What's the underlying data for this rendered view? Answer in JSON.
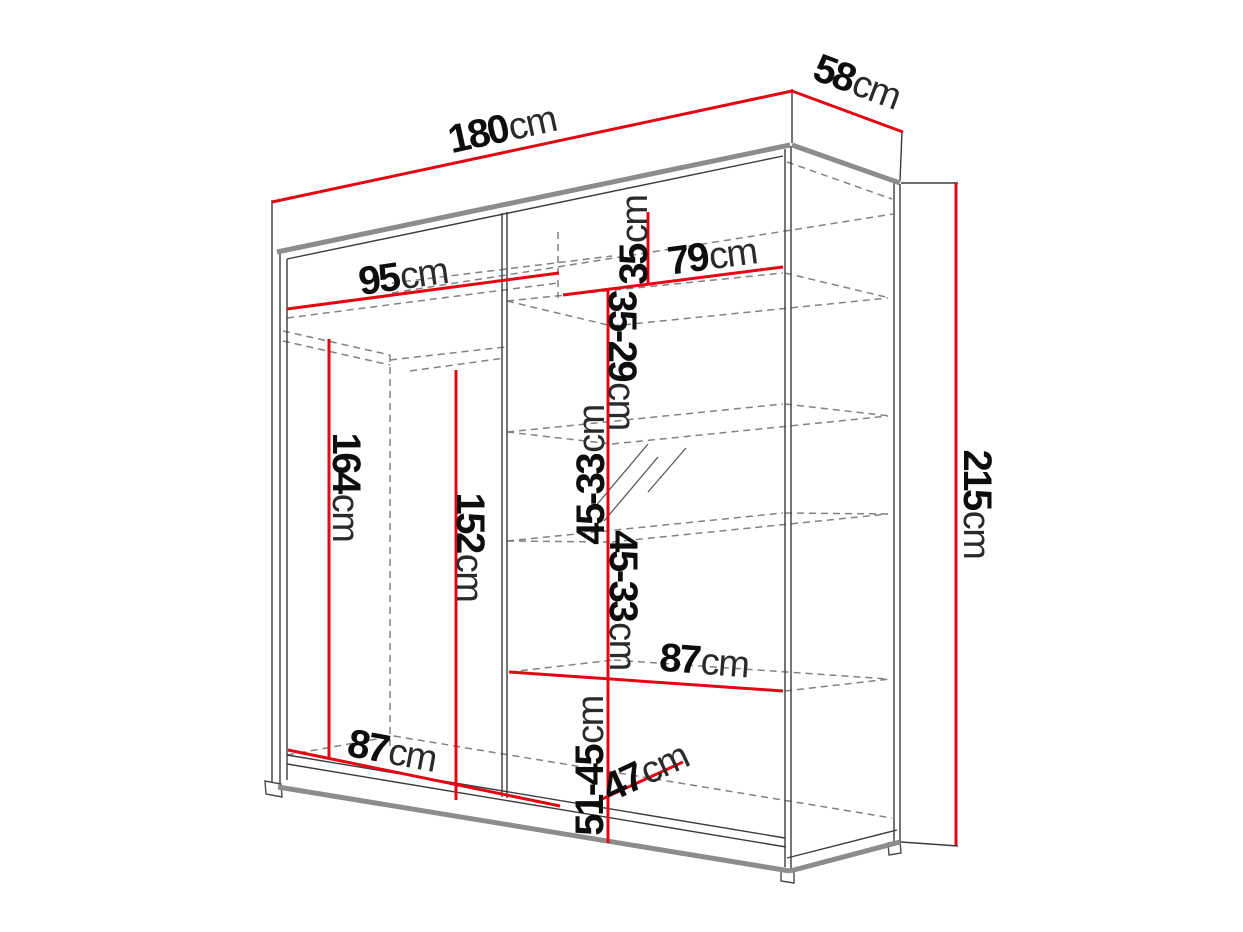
{
  "diagram": {
    "type": "wardrobe-dimension-drawing",
    "unit": "cm",
    "colors": {
      "dimension_red": "#e30613",
      "outline_thick": "#8c8c8c",
      "outline_thin": "#3c3c3c",
      "hidden_dashed": "#828282",
      "text": "#0d0d0d",
      "background": "#ffffff"
    },
    "dims": {
      "width": {
        "value": "180",
        "unit": "cm"
      },
      "depth": {
        "value": "58",
        "unit": "cm"
      },
      "height": {
        "value": "215",
        "unit": "cm"
      },
      "left_width": {
        "value": "95",
        "unit": "cm"
      },
      "top_shelf": {
        "value": "35",
        "unit": "cm"
      },
      "right_width": {
        "value": "79",
        "unit": "cm"
      },
      "gap_top": {
        "value": "35-29",
        "unit": "cm"
      },
      "gap_mid_upper": {
        "value": "45-33",
        "unit": "cm"
      },
      "gap_mid_lower": {
        "value": "45-33",
        "unit": "cm"
      },
      "shelf_width_right": {
        "value": "87",
        "unit": "cm"
      },
      "gap_bottom": {
        "value": "51-45",
        "unit": "cm"
      },
      "shelf_depth": {
        "value": "47",
        "unit": "cm"
      },
      "hanging_height": {
        "value": "164",
        "unit": "cm"
      },
      "inner_height": {
        "value": "152",
        "unit": "cm"
      },
      "shelf_width_left": {
        "value": "87",
        "unit": "cm"
      }
    }
  }
}
